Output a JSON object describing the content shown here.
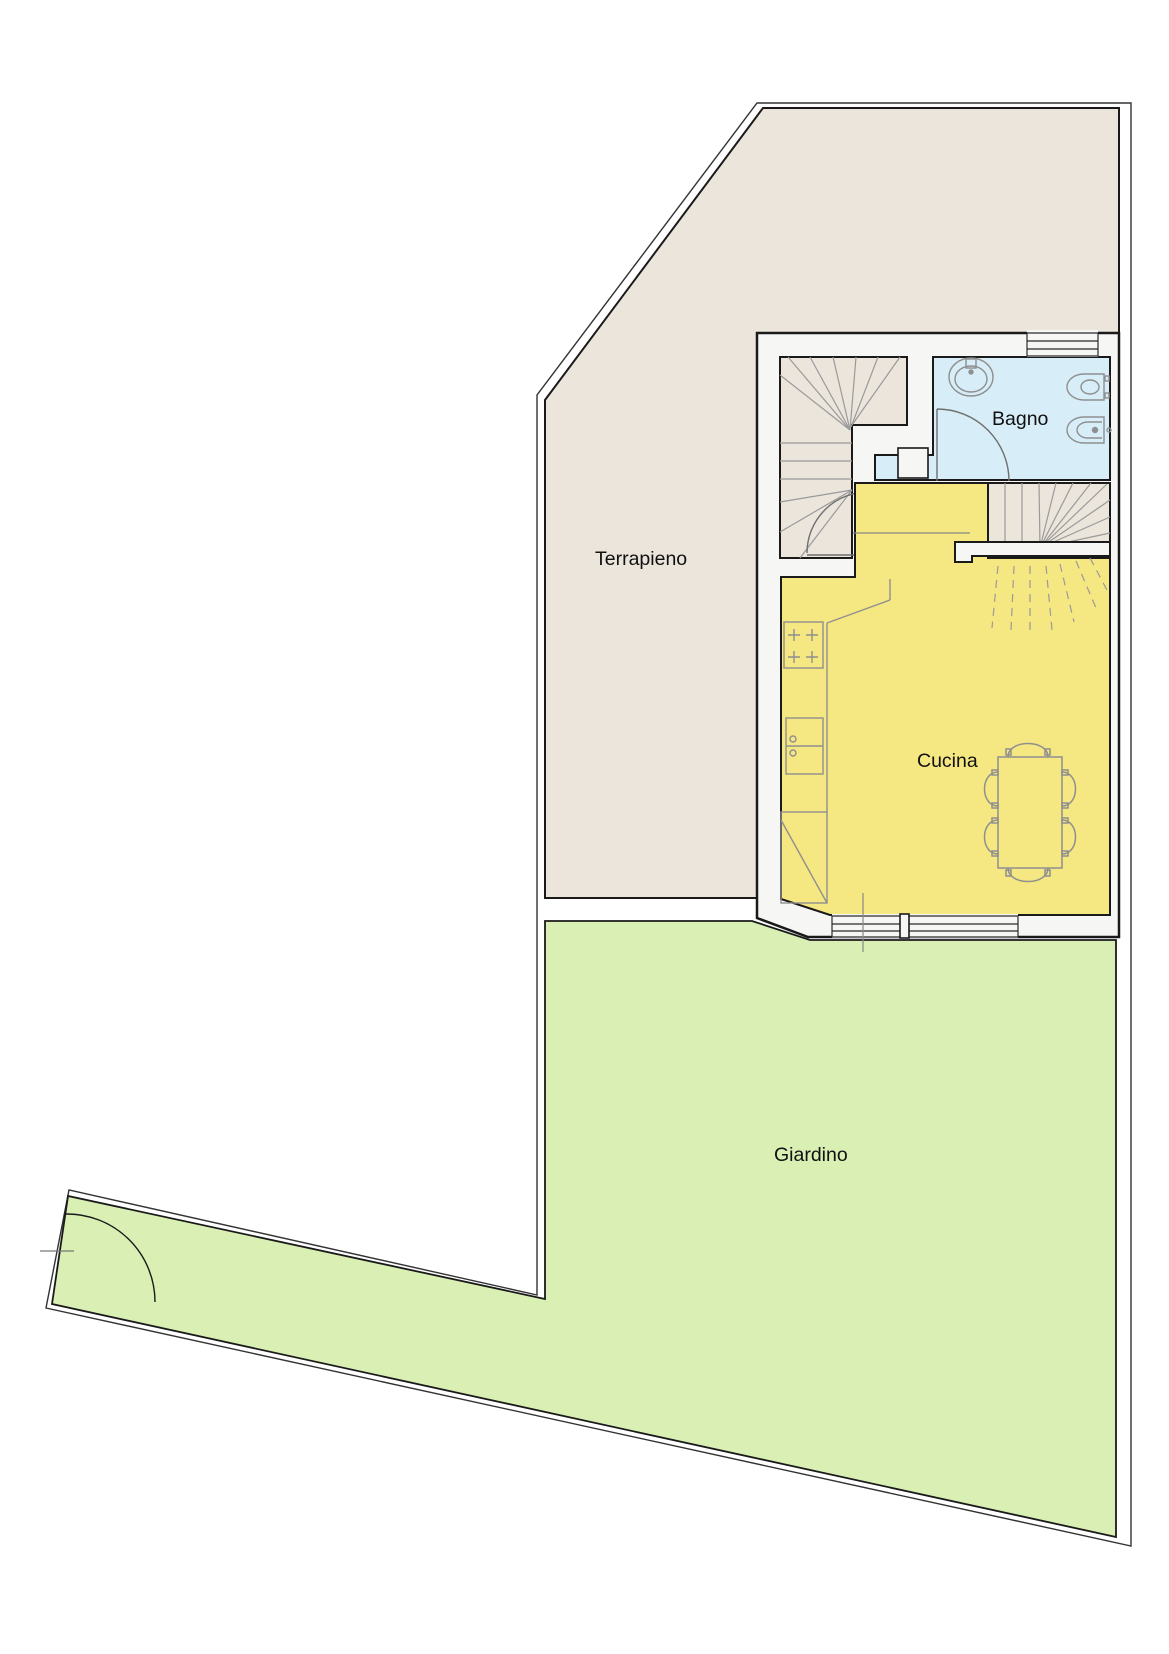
{
  "plan": {
    "title": "floor-plan",
    "labels": {
      "terrapieno": "Terrapieno",
      "bagno": "Bagno",
      "cucina": "Cucina",
      "giardino": "Giardino"
    },
    "colors": {
      "outline": "#1a1a1a",
      "wall_fill": "#f6f6f4",
      "terrapieno_fill": "#ebe5dc",
      "bagno_fill": "#d7edf8",
      "cucina_fill": "#f5e782",
      "giardino_fill": "#d9efb4",
      "furniture_stroke": "#8f8f8f",
      "stair_tread_stroke": "#9a9a9a",
      "label_color": "#111111"
    },
    "fixtures": [
      "winder-staircase-upper",
      "winder-staircase-lower",
      "bathroom-sink",
      "toilet",
      "bidet",
      "bathroom-door",
      "stair-door",
      "garden-gate",
      "kitchen-stove",
      "kitchen-sink",
      "corner-cabinet",
      "dining-table",
      "chairs-x6",
      "window-top",
      "window-bottom-left",
      "window-bottom-right"
    ]
  }
}
